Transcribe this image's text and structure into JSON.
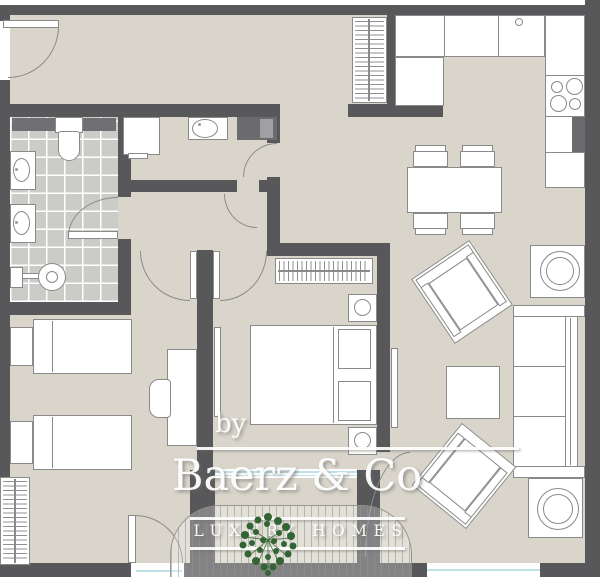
{
  "watermark": {
    "by": "by",
    "brand": "Baerz & Co",
    "tagline": "LUXURY HOMES"
  },
  "palette": {
    "wall": "#58585b",
    "floor": "#d9d5cb",
    "tile": "#cbcbc8",
    "outline": "#8a8a8a",
    "glazing_blue": "#bfe2ea",
    "logo_tree_green": "#336433",
    "watermark_white": "#ffffff"
  },
  "plan": {
    "type": "apartment-floor-plan",
    "rooms": [
      "entry-hall",
      "bathroom",
      "laundry-wc",
      "hallway",
      "twin-bedroom",
      "master-bedroom",
      "kitchen",
      "dining-area",
      "living-room",
      "balcony"
    ]
  }
}
